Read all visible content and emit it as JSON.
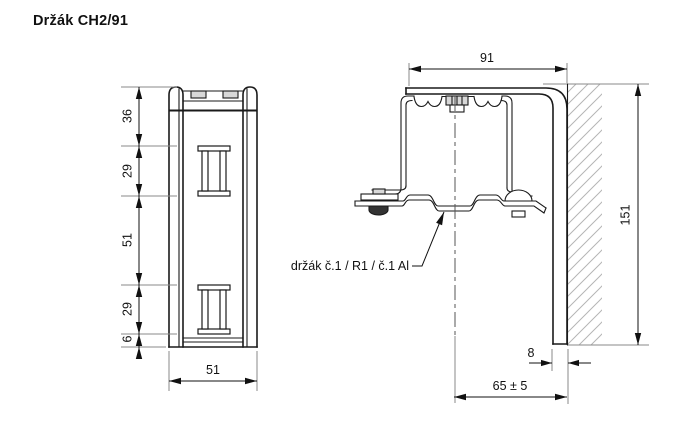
{
  "title": "Držák CH2/91",
  "front_view": {
    "height_dims": [
      "36",
      "29",
      "51",
      "29",
      "6"
    ],
    "width_dim": "51"
  },
  "side_view": {
    "width_dim": "91",
    "height_dim": "151",
    "thickness_dim": "8",
    "offset_dim": "65 ± 5",
    "callout_label": "držák č.1 / R1 / č.1 Al"
  },
  "colors": {
    "outline": "#1a1a1a",
    "dimension": "#111111",
    "extension": "#8a8a8a",
    "hatch": "#b5b5b5",
    "background": "#ffffff"
  }
}
